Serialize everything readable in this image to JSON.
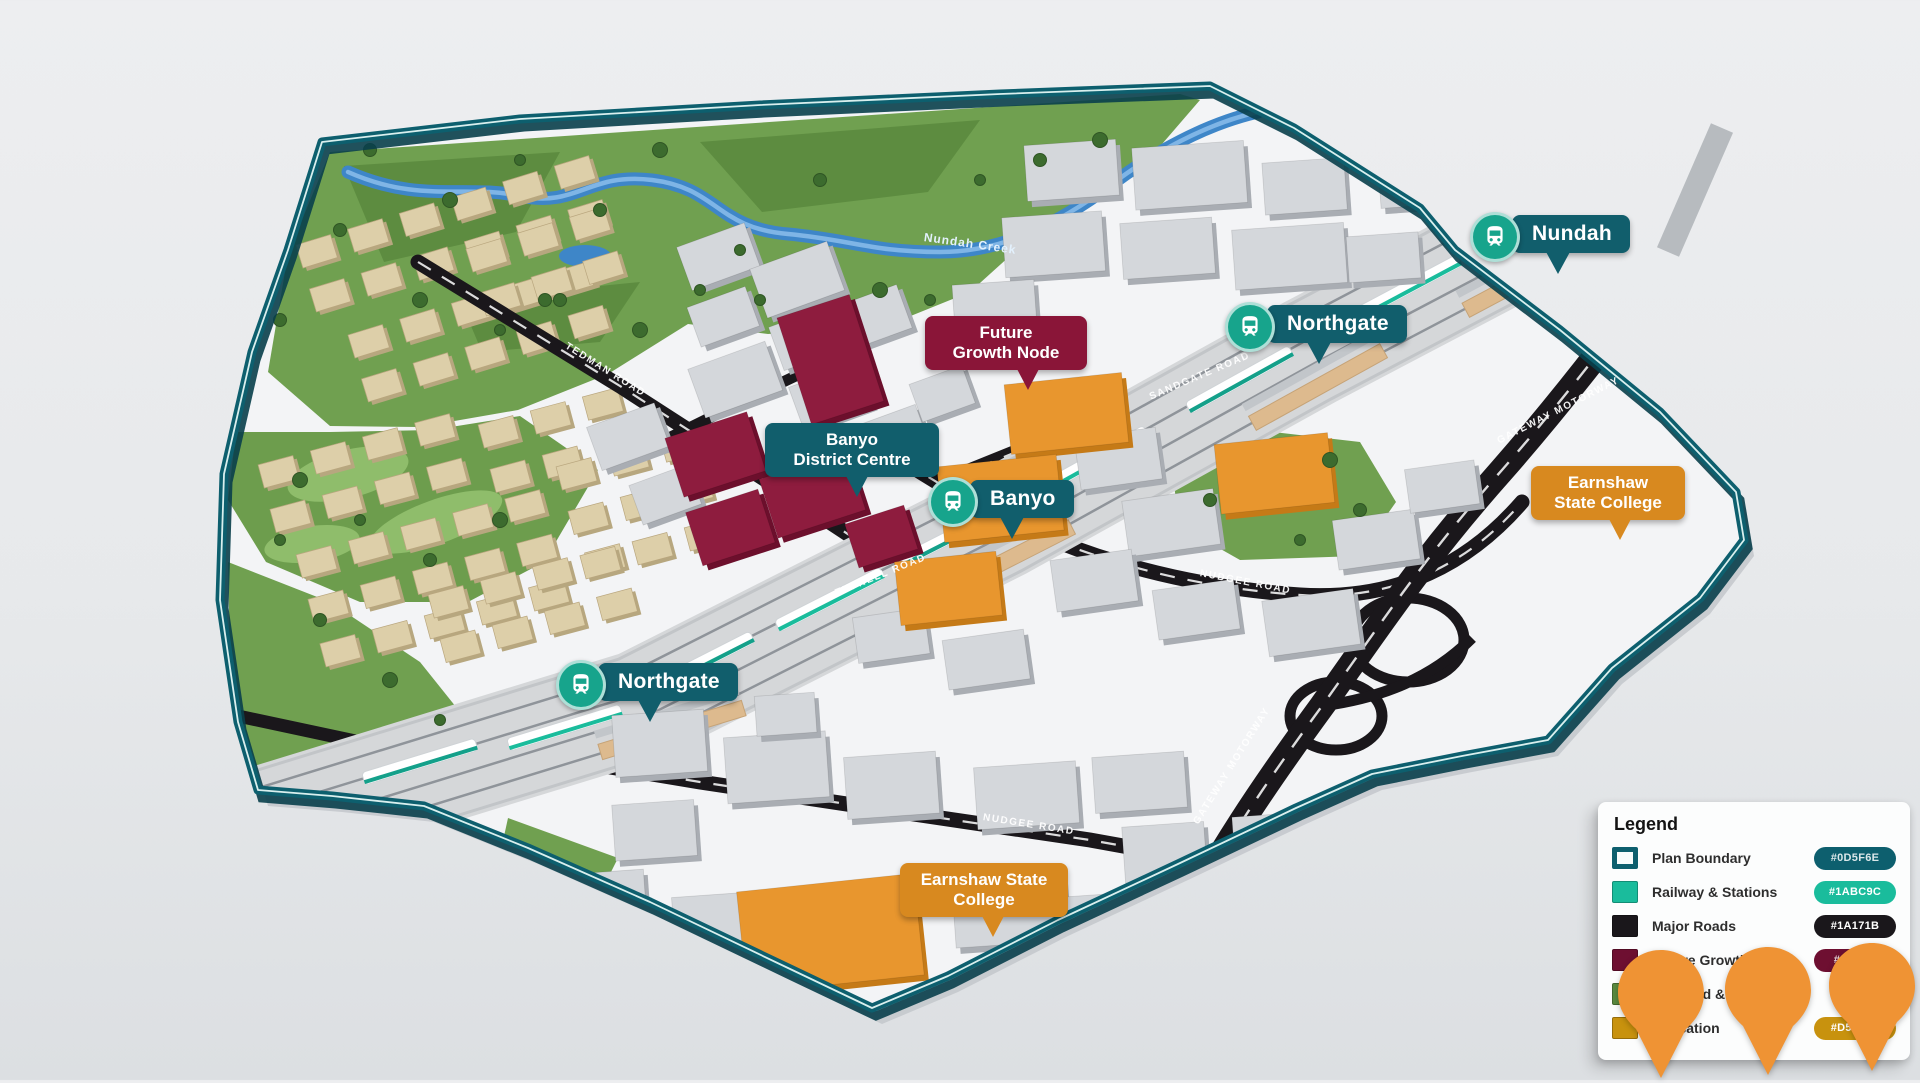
{
  "map": {
    "stations": [
      {
        "label": "Nundah",
        "x": 1470,
        "y": 212
      },
      {
        "label": "Northgate",
        "x": 1225,
        "y": 302
      },
      {
        "label": "Banyo",
        "x": 928,
        "y": 477
      },
      {
        "label": "Northgate",
        "x": 556,
        "y": 660
      }
    ],
    "area_labels": [
      {
        "lines": [
          "Future",
          "Growth Node"
        ],
        "color": "#8A1538",
        "x": 925,
        "y": 316,
        "w": 146,
        "tail": 56
      },
      {
        "lines": [
          "Banyo",
          "District Centre"
        ],
        "color": "#115E6C",
        "x": 765,
        "y": 423,
        "w": 158,
        "tail": 46
      },
      {
        "lines": [
          "Earnshaw",
          "State College"
        ],
        "color": "#D8891F",
        "x": 1531,
        "y": 466,
        "w": 138,
        "tail": 50
      },
      {
        "lines": [
          "Earnshaw State",
          "College"
        ],
        "color": "#D8891F",
        "x": 900,
        "y": 863,
        "w": 152,
        "tail": 48
      }
    ],
    "road_labels": [
      {
        "text": "TEDMAN ROAD",
        "x": 566,
        "y": 340,
        "rot": 32
      },
      {
        "text": "TUFNELL ROAD",
        "x": 836,
        "y": 588,
        "rot": -22
      },
      {
        "text": "SANDGATE ROAD",
        "x": 1150,
        "y": 392,
        "rot": -23
      },
      {
        "text": "NUDGEE ROAD",
        "x": 1200,
        "y": 568,
        "rot": 11
      },
      {
        "text": "NUDGEE ROAD",
        "x": 983,
        "y": 812,
        "rot": 9
      },
      {
        "text": "GATEWAY MOTORWAY",
        "x": 1498,
        "y": 436,
        "rot": -27
      },
      {
        "text": "GATEWAY MOTORWAY",
        "x": 1196,
        "y": 818,
        "rot": -58
      }
    ],
    "creek_label": {
      "text": "Nundah Creek",
      "x": 924,
      "y": 230,
      "rot": 8
    }
  },
  "legend": {
    "title": "Legend",
    "items": [
      {
        "label": "Plan Boundary",
        "hex": "#0D5F6E",
        "swatch": "boundary",
        "swatch_color": "#0D5F6E",
        "badge_bg": "#0D5F6E"
      },
      {
        "label": "Railway & Stations",
        "hex": "#1ABC9C",
        "swatch": "fill",
        "swatch_color": "#1ABC9C",
        "badge_bg": "#1ABC9C"
      },
      {
        "label": "Major Roads",
        "hex": "#1A171B",
        "swatch": "fill",
        "swatch_color": "#1A171B",
        "badge_bg": "#1A171B"
      },
      {
        "label": "Future Growth Node",
        "hex": "#6e0f31",
        "swatch": "fill",
        "swatch_color": "#6e0f31",
        "badge_bg": "#6e0f31"
      },
      {
        "label": "Parkland & Rec",
        "hex": "",
        "swatch": "fill",
        "swatch_color": "#5A8A3E",
        "badge_bg": ""
      },
      {
        "label": "Education",
        "hex": "#D5780B",
        "swatch": "fill",
        "swatch_color": "#C8920E",
        "badge_bg": "#C8920E"
      }
    ]
  },
  "pins": [
    {
      "x": 1618,
      "y": 950
    },
    {
      "x": 1725,
      "y": 947
    },
    {
      "x": 1829,
      "y": 943
    }
  ],
  "colors": {
    "boundary": "#0D5F6E",
    "railway": "#1ABC9C",
    "major_roads": "#1A171B",
    "future_growth_node": "#6e0f31",
    "parkland": "#5A8A3E",
    "education": "#C8920E",
    "pin": "#EF9334",
    "water": "#3E86C8",
    "station_pill": "#115E6C"
  }
}
